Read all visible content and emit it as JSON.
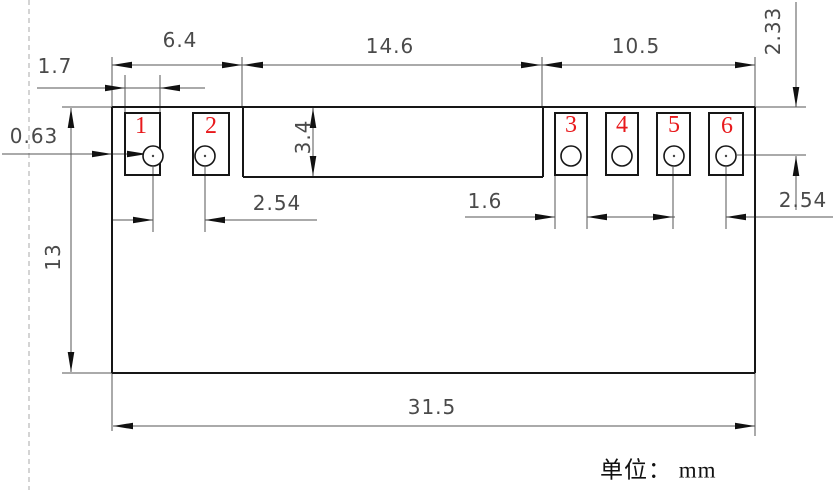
{
  "drawing": {
    "unit_note": "单位： mm",
    "dims": {
      "span_left": "6.4",
      "span_middle": "14.6",
      "span_right": "10.5",
      "pad_width_left": "1.7",
      "edge_to_pad": "0.63",
      "middle_depth": "3.4",
      "pitch_left": "2.54",
      "pad_width_right": "1.6",
      "pitch_right": "2.54",
      "edge_to_hole": "2.33",
      "body_height": "13",
      "body_width": "31.5"
    },
    "pins": [
      {
        "number": "1"
      },
      {
        "number": "2"
      },
      {
        "number": "3"
      },
      {
        "number": "4"
      },
      {
        "number": "5"
      },
      {
        "number": "6"
      }
    ],
    "colors": {
      "pin_number": "#e8191c",
      "outline": "#161616",
      "dimension_line": "#555555",
      "arrowhead": "#111111",
      "margin_line": "#b8b8b8"
    }
  }
}
